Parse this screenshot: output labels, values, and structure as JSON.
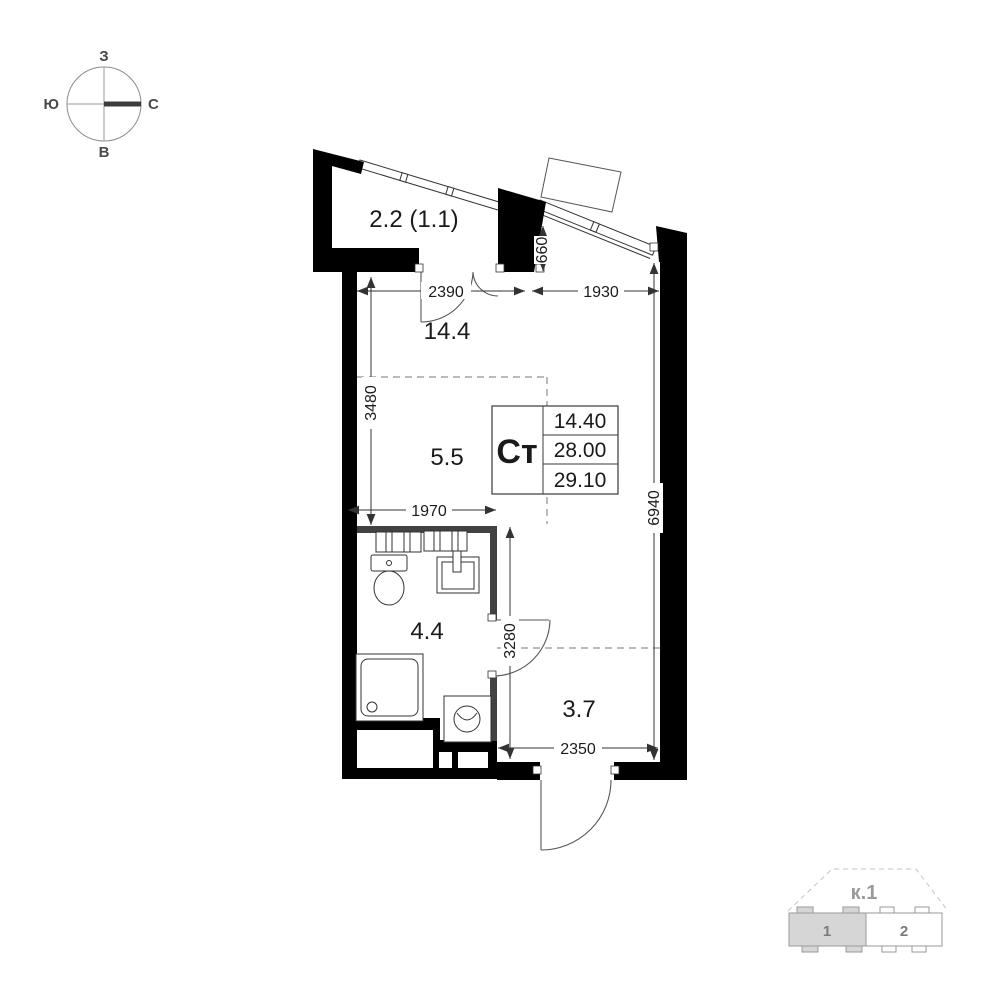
{
  "compass": {
    "west": "З",
    "south": "Ю",
    "north": "С",
    "east": "В"
  },
  "plan": {
    "room_labels": {
      "balcony": "2.2 (1.1)",
      "living": "14.4",
      "kitchen": "5.5",
      "bathroom": "4.4",
      "hallway": "3.7"
    },
    "info_box": {
      "type": "Ст",
      "row1": "14.40",
      "row2": "28.00",
      "row3": "29.10"
    },
    "dims": {
      "d2390": "2390",
      "d1930": "1930",
      "d660": "660",
      "d3480": "3480",
      "d1970": "1970",
      "d6940": "6940",
      "d3280": "3280",
      "d2350": "2350"
    }
  },
  "key_plan": {
    "title": "к.1",
    "section1": "1",
    "section2": "2"
  }
}
